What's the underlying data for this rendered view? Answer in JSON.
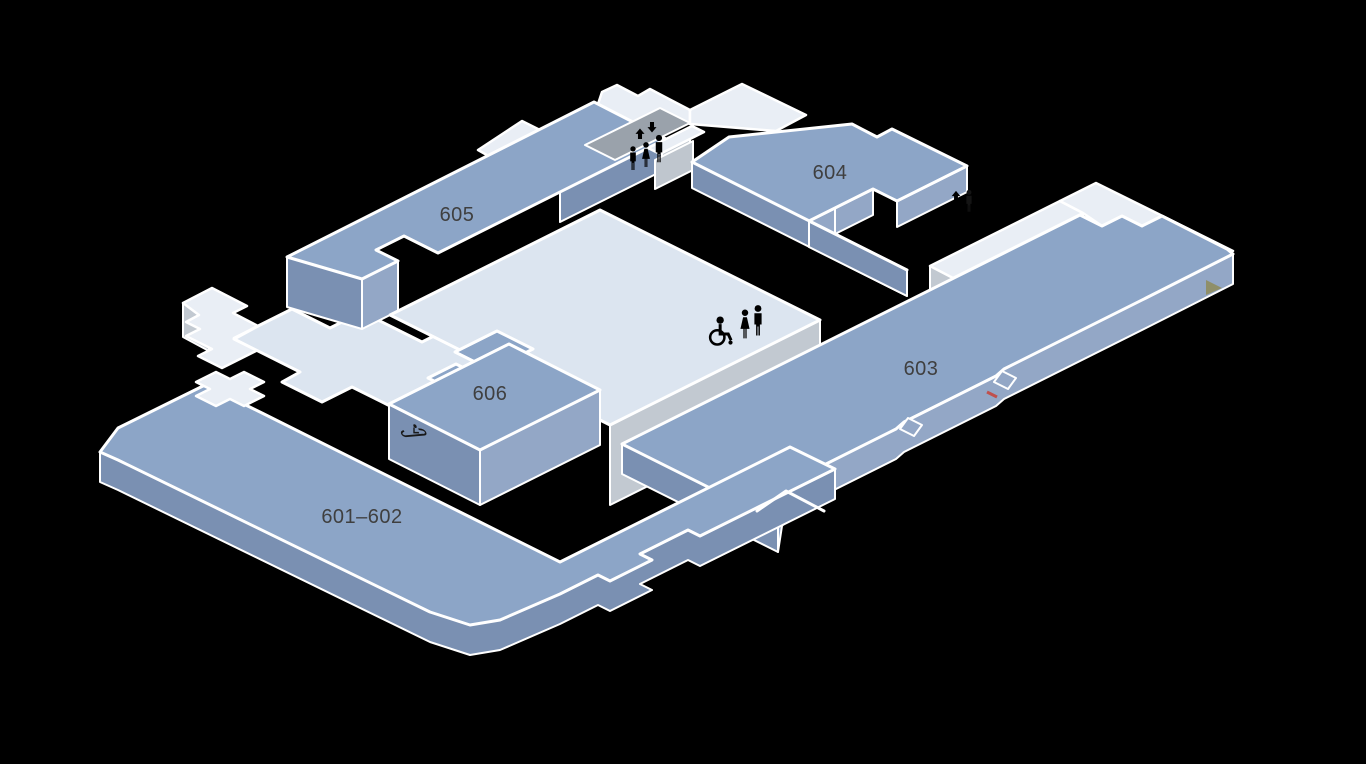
{
  "map": {
    "title": "Exhibition halls floor map (level 6)",
    "background": "#000000",
    "rooms": [
      {
        "id": "601-602",
        "label": "601–602"
      },
      {
        "id": "603",
        "label": "603"
      },
      {
        "id": "604",
        "label": "604"
      },
      {
        "id": "605",
        "label": "605"
      },
      {
        "id": "606",
        "label": "606"
      }
    ],
    "icons": [
      {
        "name": "elevator-up-down-arrows",
        "location": "upper-center-corridor"
      },
      {
        "name": "people-figures",
        "location": "upper-center-corridor",
        "count": 3
      },
      {
        "name": "wheelchair-icon",
        "location": "central-concourse"
      },
      {
        "name": "restroom-man-woman",
        "location": "central-concourse",
        "count": 2
      },
      {
        "name": "escalator-icon",
        "location": "room-606-front-face"
      },
      {
        "name": "up-arrow-icon",
        "location": "room-604-right-edge"
      }
    ],
    "colors": {
      "room_top": "#8CA5C7",
      "room_side_dark": "#7A90B2",
      "room_side_light": "#93A7C6",
      "concourse_top": "#DCE5F0",
      "concourse_bright": "#E9EEF5",
      "concourse_side": "#C2C9D1",
      "corridor_floor": "#9AA2AB",
      "outline": "#FFFFFF",
      "label_text": "#3F3F3F",
      "accent_red": "#C0504D",
      "accent_olive": "#8F8F69"
    }
  }
}
